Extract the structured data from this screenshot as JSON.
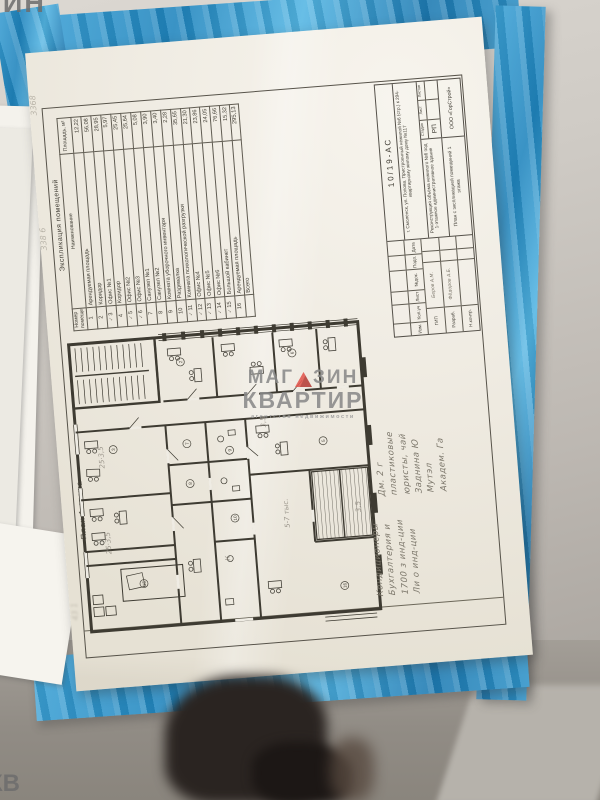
{
  "watermark": {
    "word1_a": "МАГ",
    "word1_b": "ЗИН",
    "word2": "КВАРТИР",
    "tagline": "агентство недвижимости"
  },
  "corner_fragments": {
    "top_left": "ЗИН",
    "bottom_left": "КВ"
  },
  "sheet": {
    "plan_label": "План 1 этажа",
    "explication": {
      "title": "Экспликация помещений",
      "columns": {
        "num": "Номер помещения",
        "name": "Наименование",
        "area": "Площадь, м²"
      },
      "rows": [
        {
          "tick": "",
          "num": "1",
          "name": "Арендуемая площадь",
          "area": "12,22"
        },
        {
          "tick": "",
          "num": "2",
          "name": "Коридор",
          "area": "56,08"
        },
        {
          "tick": "✓",
          "num": "3",
          "name": "Офис №1",
          "area": "28,95"
        },
        {
          "tick": "",
          "num": "4",
          "name": "Коридор",
          "area": "5,97"
        },
        {
          "tick": "✓",
          "num": "5",
          "name": "Офис №2",
          "area": "25,45"
        },
        {
          "tick": "✓",
          "num": "6",
          "name": "Офис №3",
          "area": "25,64"
        },
        {
          "tick": "",
          "num": "7",
          "name": "Санузел №1",
          "area": "5,08"
        },
        {
          "tick": "",
          "num": "8",
          "name": "Санузел №2",
          "area": "3,90"
        },
        {
          "tick": "",
          "num": "9",
          "name": "Комната уборочного инвентаря",
          "area": "3,40"
        },
        {
          "tick": "",
          "num": "10",
          "name": "Раздевалка",
          "area": "2,28"
        },
        {
          "tick": "✓",
          "num": "11",
          "name": "Комната психологической разгрузки",
          "area": "35,65"
        },
        {
          "tick": "✓",
          "num": "12",
          "name": "Офис №4",
          "area": "21,30"
        },
        {
          "tick": "✓",
          "num": "13",
          "name": "Офис №5",
          "area": "23,86"
        },
        {
          "tick": "✓",
          "num": "14",
          "name": "Офис №6",
          "area": "24,05"
        },
        {
          "tick": "✓",
          "num": "15",
          "name": "Большой кабинет",
          "area": "76,66"
        },
        {
          "tick": "",
          "num": "16",
          "name": "Арендуемая площадь",
          "area": "15,32"
        }
      ],
      "total_label": "Всего",
      "total_area": "295,13"
    },
    "titleblock": {
      "doc_number": "10/19-АС",
      "address": "г. Смоленск, ул. Попова. Пристроенный нежилой №6 (стр.) к 294-квартирному жилому дому №117",
      "project": "Реконструкция объёма нежилого №6 под 1-этажное административное здание",
      "stage_headers": [
        "Стадия",
        "Лист",
        "Листов"
      ],
      "stage": "РП",
      "sheet_title": "План с экспликацией помещений 1 этажа",
      "company": "ООО «ГорСтрой»",
      "sig_headers": [
        "Изм.",
        "Кол.уч",
        "Лист",
        "№док.",
        "Подп.",
        "Дата"
      ],
      "sig_rows": [
        {
          "role": "ГИП",
          "name": "Беров А.М."
        },
        {
          "role": "Разраб.",
          "name": "Фёдоров А.Б."
        },
        {
          "role": "Н.контр.",
          "name": ""
        }
      ]
    },
    "plan": {
      "markers": [
        "2",
        "3",
        "5",
        "6",
        "7",
        "8",
        "9",
        "10",
        "15",
        "16"
      ],
      "marks": {
        "m1": "25·3,5",
        "m2": "25·3,5",
        "m3": "3,5",
        "m4": "5-7 тыс.",
        "m5": "3,5",
        "m6": "К"
      }
    }
  },
  "notes": {
    "group1": [
      "Дм. 2 г",
      "пластиковые",
      "юристы, чай",
      "Заднина Ю",
      "Мутэл",
      "Академ. Га"
    ],
    "group2": [
      "Кондиционеры",
      "Бухгалтерия и",
      "1700 з инд-ции",
      "Ли о инд-ции"
    ],
    "margin1": "3368",
    "margin2": "338 6",
    "margin3": "43 1"
  }
}
